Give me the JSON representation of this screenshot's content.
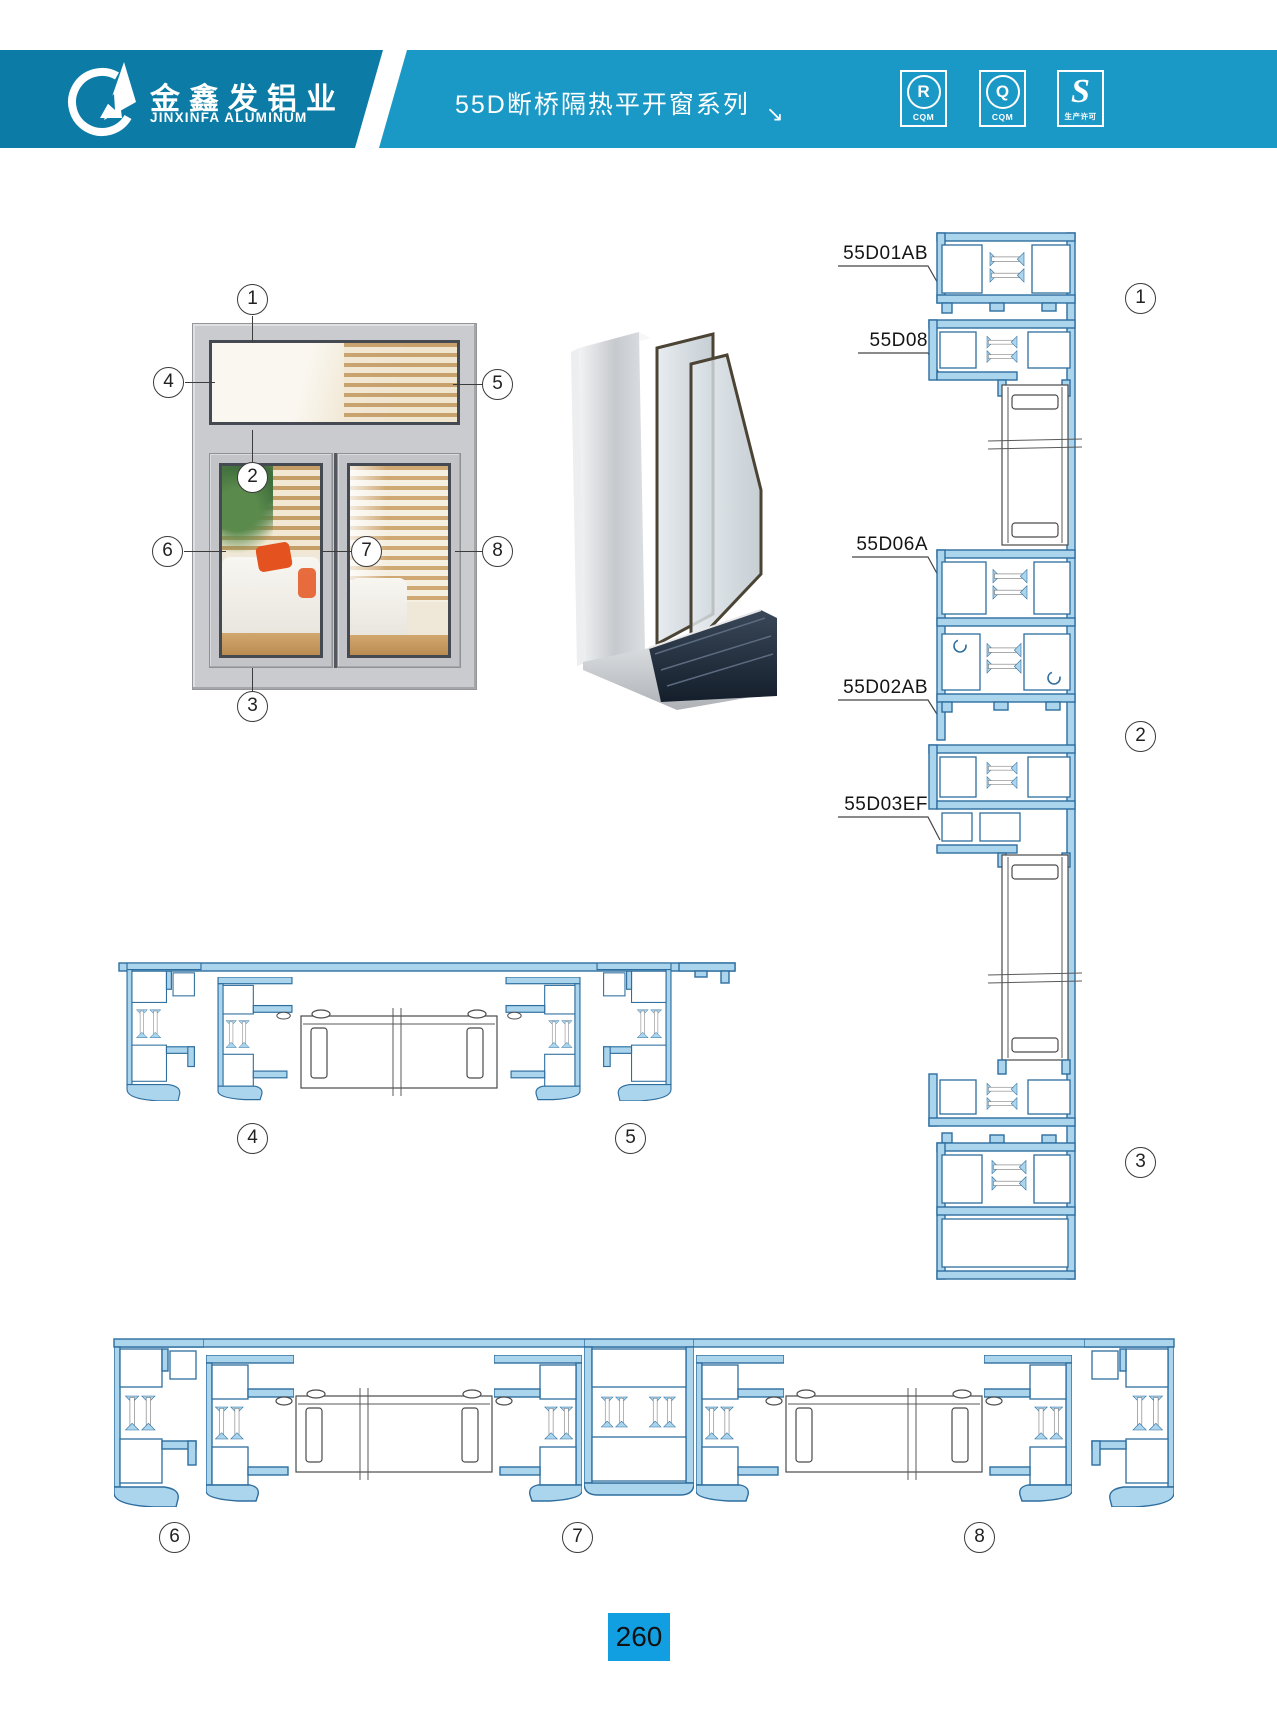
{
  "header": {
    "company_cn": "金鑫发铝业",
    "company_en": "JINXINFA ALUMINUM",
    "series_title": "55D断桥隔热平开窗系列",
    "arrow_glyph": "↘",
    "colors": {
      "band_left": "#0c7ca6",
      "band_right": "#1b99c6"
    },
    "badges": [
      {
        "letter": "R",
        "sub": "CQM"
      },
      {
        "letter": "Q",
        "sub": "CQM"
      },
      {
        "letter": "S",
        "sub": "生产许可"
      }
    ]
  },
  "profile_labels": {
    "p1": "55D01AB",
    "p2": "55D08",
    "p3": "55D06A",
    "p4": "55D02AB",
    "p5": "55D03EF"
  },
  "callouts": {
    "e1": "1",
    "e2": "2",
    "e3": "3",
    "e4": "4",
    "e5": "5",
    "e6": "6",
    "e7": "7",
    "e8": "8",
    "v1": "1",
    "v2": "2",
    "v3": "3",
    "h4": "4",
    "h5": "5",
    "h6": "6",
    "h7": "7",
    "h8": "8"
  },
  "footer": {
    "page_number": "260",
    "badge_color": "#129fe2"
  }
}
